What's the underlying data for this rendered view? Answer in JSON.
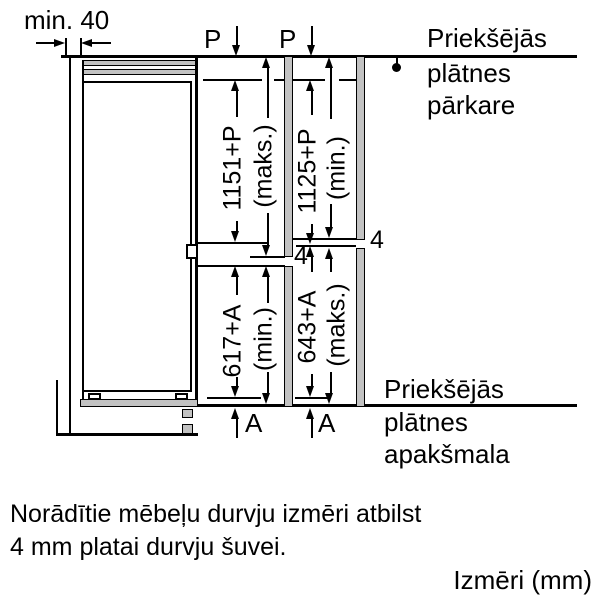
{
  "labels": {
    "min_gap": "min. 40",
    "p": "P",
    "a": "A",
    "gap": "4"
  },
  "dims": {
    "upper_left_value": "1151+P",
    "upper_left_qualifier": "(maks.)",
    "upper_right_value": "1125+P",
    "upper_right_qualifier": "(min.)",
    "lower_left_value": "617+A",
    "lower_left_qualifier": "(min.)",
    "lower_right_value": "643+A",
    "lower_right_qualifier": "(maks.)"
  },
  "callouts": {
    "top": {
      "line1": "Priekšējās",
      "line2": "plātnes",
      "line3": "pārkare"
    },
    "bottom": {
      "line1": "Priekšējās",
      "line2": "plātnes",
      "line3": "apakšmala"
    }
  },
  "note": {
    "line1": "Norādītie mēbeļu durvju izmēri atbilst",
    "line2": "4 mm platai durvju šuvei."
  },
  "units": "Izmēri (mm)",
  "colors": {
    "panel_fill": "#c2c2c2",
    "line": "#000000"
  }
}
